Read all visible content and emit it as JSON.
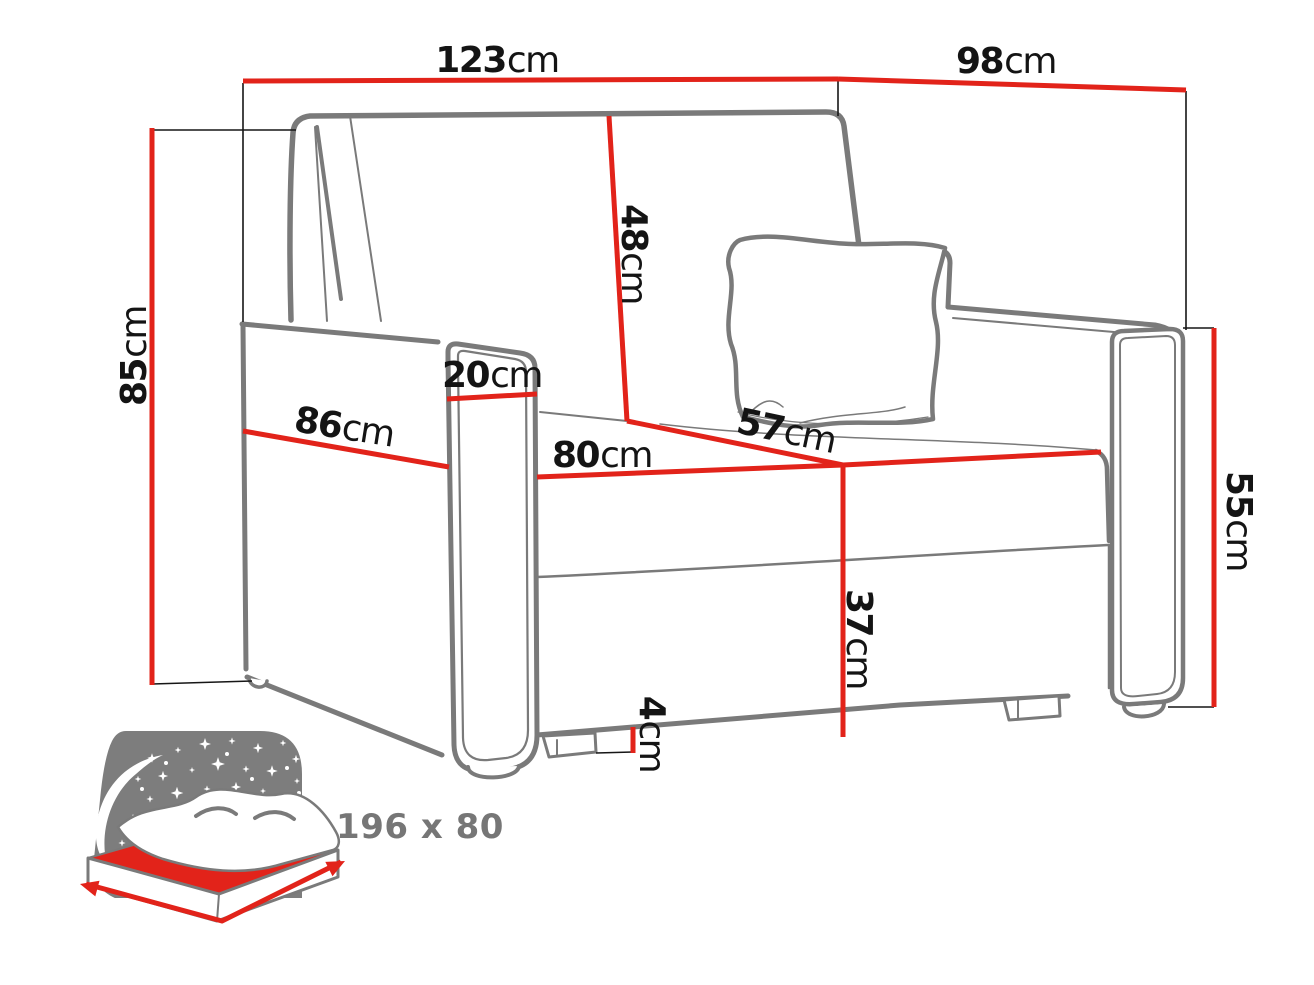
{
  "diagram": {
    "type": "furniture-dimension-diagram",
    "subject": "armchair sofa bed line drawing",
    "dimensions": {
      "overall_width": {
        "value": "123",
        "unit": "cm"
      },
      "overall_depth": {
        "value": "98",
        "unit": "cm"
      },
      "overall_height": {
        "value": "85",
        "unit": "cm"
      },
      "backrest_height": {
        "value": "48",
        "unit": "cm"
      },
      "armrest_width": {
        "value": "20",
        "unit": "cm"
      },
      "side_depth": {
        "value": "86",
        "unit": "cm"
      },
      "seat_width": {
        "value": "80",
        "unit": "cm"
      },
      "seat_depth": {
        "value": "57",
        "unit": "cm"
      },
      "armrest_height": {
        "value": "55",
        "unit": "cm"
      },
      "seat_height": {
        "value": "37",
        "unit": "cm"
      },
      "leg_height": {
        "value": "4",
        "unit": "cm"
      }
    },
    "sleeping_area": {
      "label": "196 x 80"
    },
    "colors": {
      "dimension_red": "#e2231a",
      "outline_gray": "#7a7a7a",
      "icon_gray": "#7d7d7d",
      "text_black": "#141414"
    }
  }
}
